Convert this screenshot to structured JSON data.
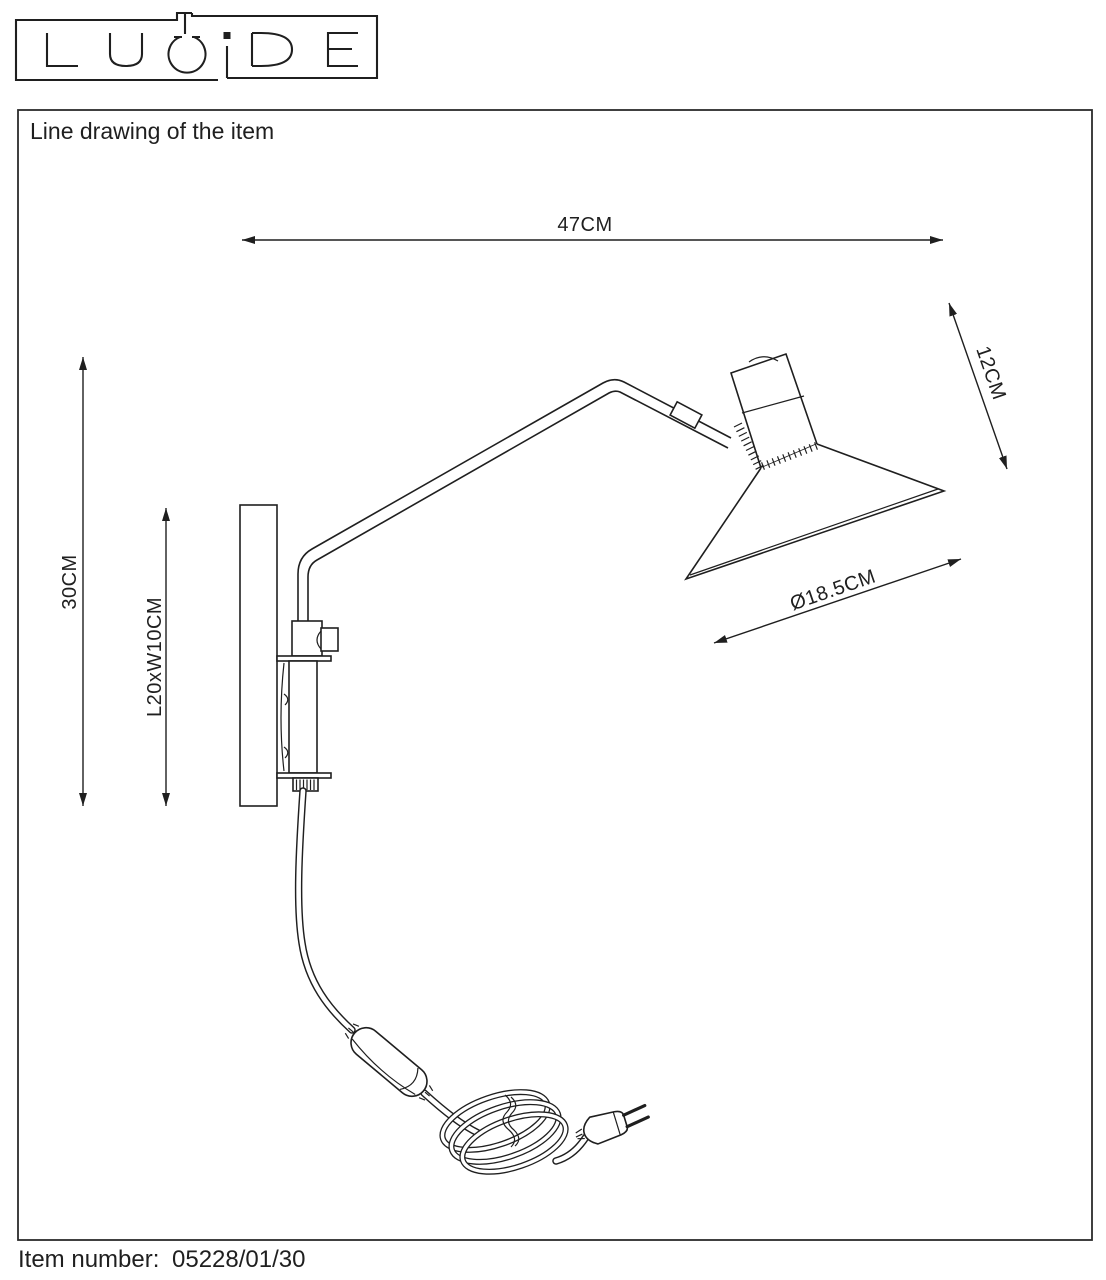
{
  "logo": {
    "brand": "LUCIDE",
    "letters": [
      "L",
      "U",
      "C",
      "i",
      "D",
      "E"
    ]
  },
  "header": {
    "title": "Line drawing of the item"
  },
  "dimensions": {
    "total_width": {
      "label": "47CM"
    },
    "head_depth": {
      "label": "12CM"
    },
    "total_height": {
      "label": "30CM"
    },
    "backplate": {
      "label": "L20xW10CM"
    },
    "shade_diameter": {
      "label": "Ø18.5CM"
    }
  },
  "footer": {
    "label": "Item number:",
    "value": "05228/01/30"
  },
  "colors": {
    "ink": "#1f1f1f",
    "background": "#ffffff"
  }
}
